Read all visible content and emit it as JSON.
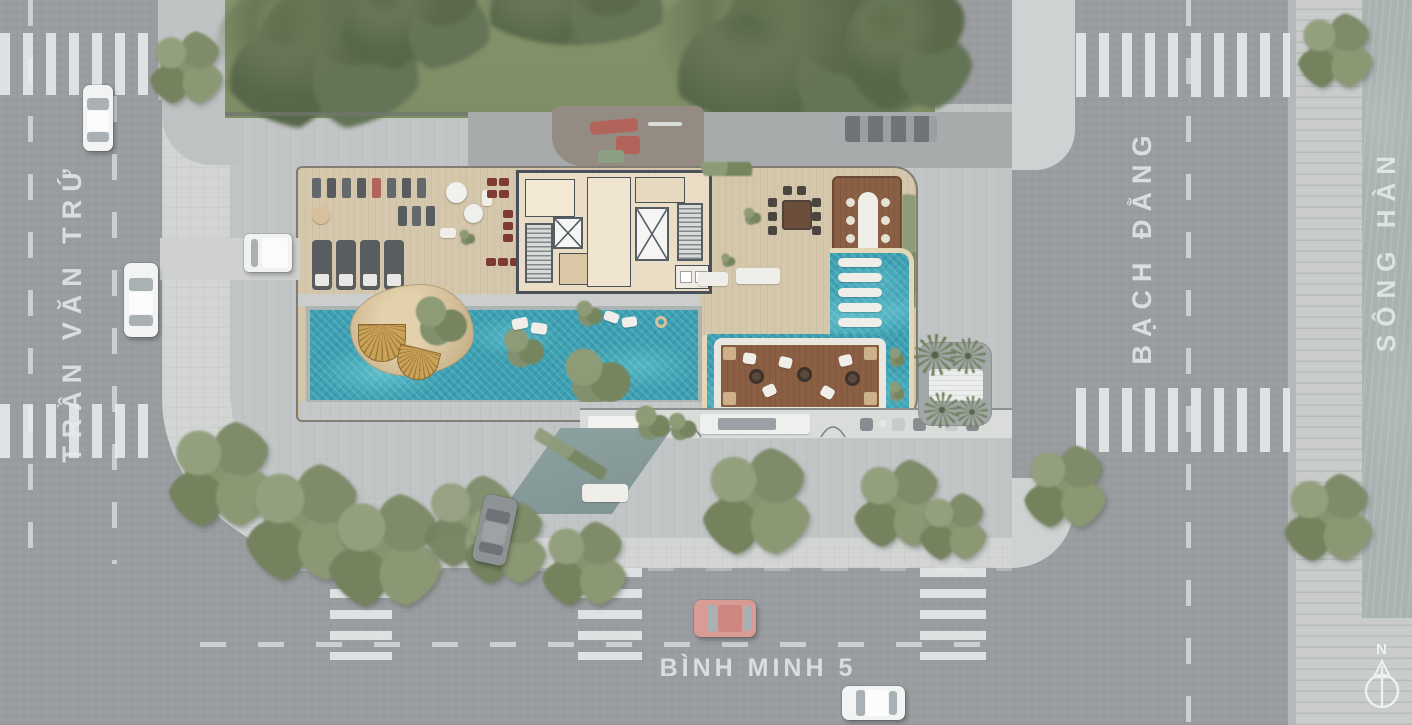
{
  "labels": {
    "street_left": "TRẦN VĂN TRỨ",
    "street_right": "BẠCH ĐẰNG",
    "river": "SÔNG HÀN",
    "street_bottom": "BÌNH MINH 5",
    "compass_north": "N"
  },
  "palette": {
    "asphalt": "#9a9da0",
    "plaza_paving": "#c3c6c6",
    "sidewalk_light": "#d3d5d4",
    "pool_water": "#3fa3b5",
    "river_water": "#a8b3b1",
    "wood_deck": "#d5c7ac",
    "dark_wood_deck": "#8a5f43",
    "greenery": "#7c8a68",
    "crosswalk_stripe": "#e9ebeb",
    "street_label_text": "#e4e8e8"
  }
}
